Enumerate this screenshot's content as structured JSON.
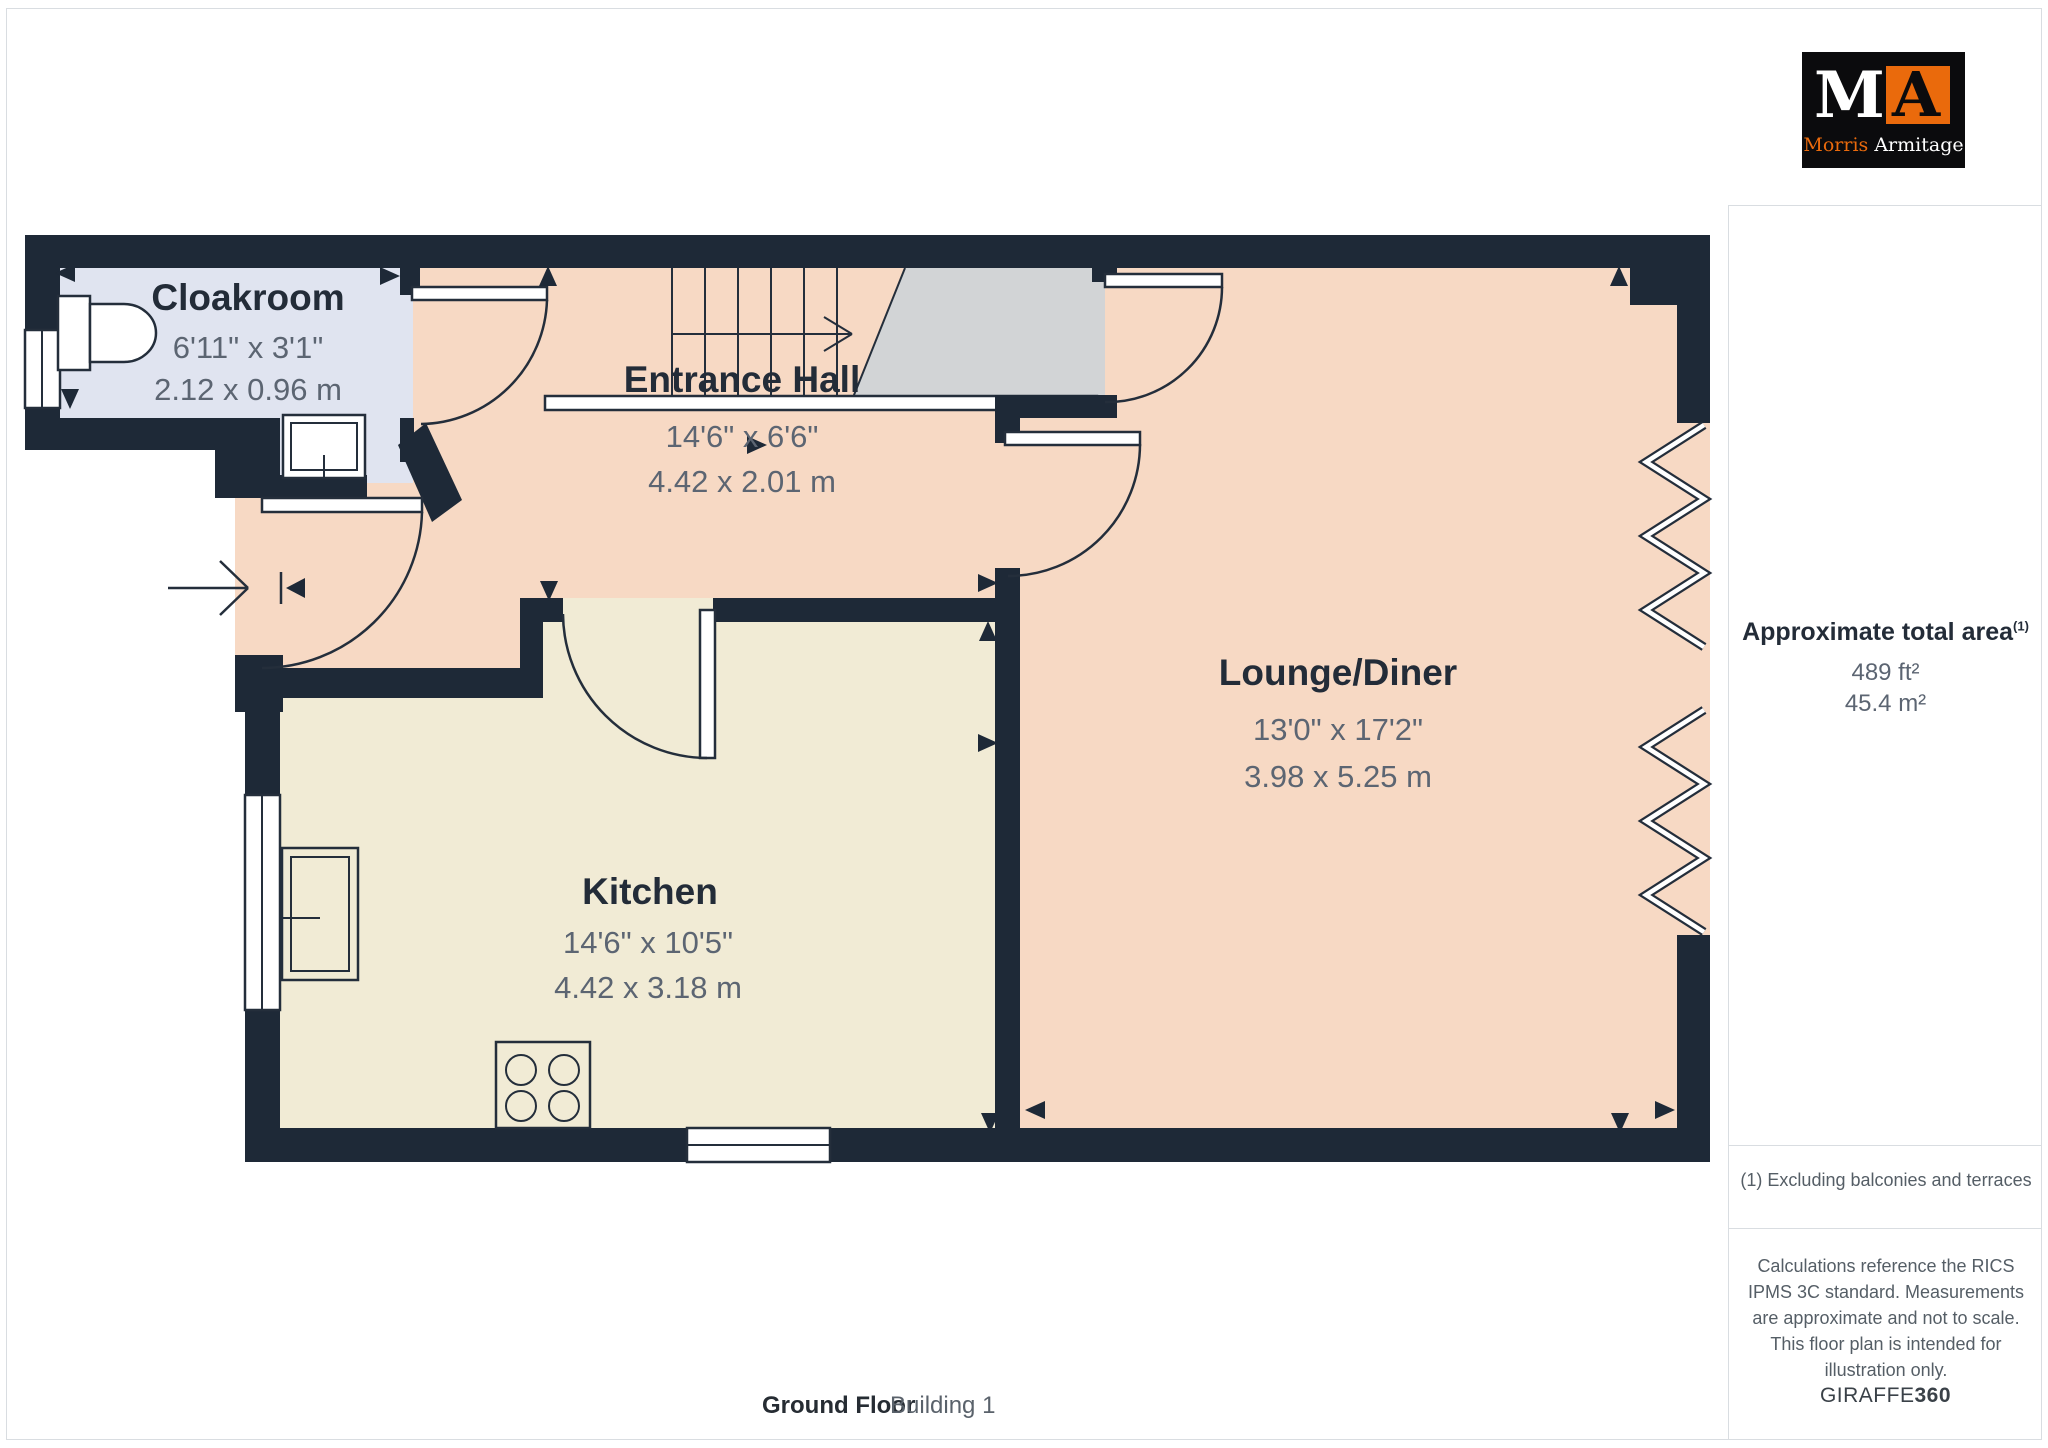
{
  "colors": {
    "wall": "#1e2937",
    "hall": "#f7d9c4",
    "kitchen": "#f1ebd5",
    "cloakroom": "#e0e4f0",
    "landing": "#d2d4d6",
    "stroke": "#242e3b",
    "title_text": "#232c38",
    "dim_text": "#5c6572",
    "orange": "#ea6a0c",
    "divider": "#d9dde1",
    "muted_text": "#555e66"
  },
  "logo": {
    "monogram_m": "M",
    "monogram_a": "A",
    "name_first": "Morris",
    "name_second": "Armitage"
  },
  "rooms": {
    "cloakroom": {
      "name": "Cloakroom",
      "imperial": "6'11\" x 3'1\"",
      "metric": "2.12 x 0.96 m"
    },
    "entrance_hall": {
      "name": "Entrance Hall",
      "imperial": "14'6\" x 6'6\"",
      "metric": "4.42 x 2.01 m"
    },
    "lounge_diner": {
      "name": "Lounge/Diner",
      "imperial": "13'0\" x 17'2\"",
      "metric": "3.98 x 5.25 m"
    },
    "kitchen": {
      "name": "Kitchen",
      "imperial": "14'6\" x 10'5\"",
      "metric": "4.42 x 3.18 m"
    }
  },
  "sidebar": {
    "area_title": "Approximate total area",
    "area_footnote_marker": "(1)",
    "area_imperial": "489 ft²",
    "area_metric": "45.4 m²",
    "footnote": "(1) Excluding balconies and terraces",
    "disclaimer": "Calculations reference the RICS IPMS 3C standard. Measurements are approximate and not to scale. This floor plan is intended for illustration only.",
    "brand_name": "GIRAFFE",
    "brand_suffix": "360"
  },
  "footer": {
    "floor_label": "Ground Floor",
    "building_label": "Building 1"
  }
}
